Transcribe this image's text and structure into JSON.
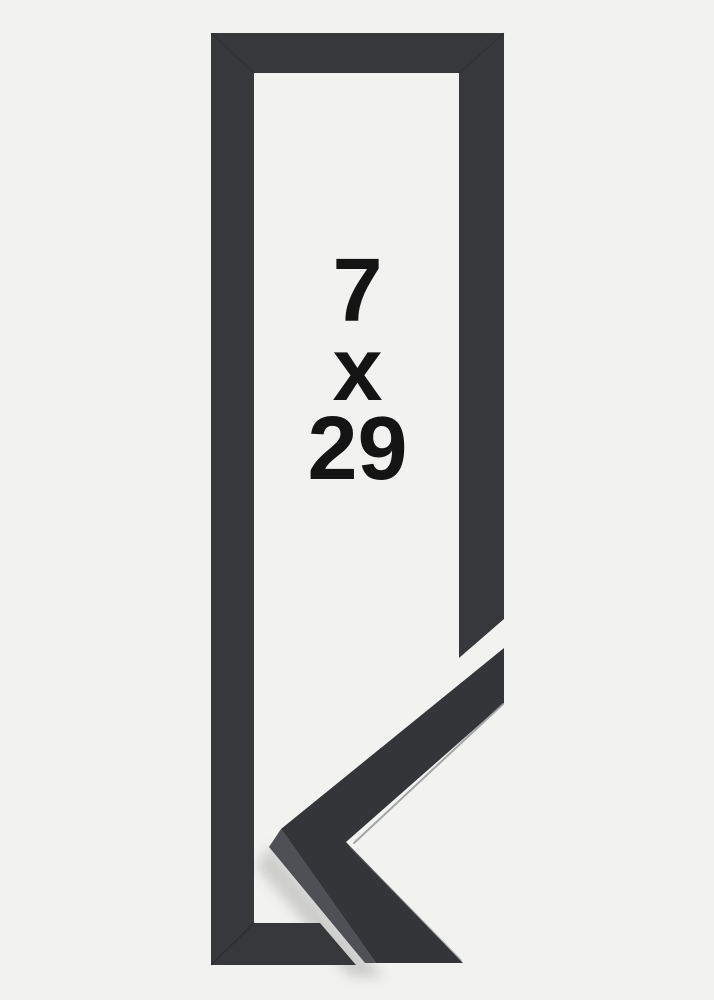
{
  "product": {
    "description": "black picture frame corner sample photo",
    "size_label": {
      "lines": [
        "7",
        "x",
        "29"
      ],
      "full": "7 x 29"
    }
  },
  "colors": {
    "background": "#f2f2f1",
    "opening": "#f2f2f1",
    "frame": "#37383b",
    "sample": "#343538",
    "sample_side": "#4e5055",
    "edge_highlight": "#8f9195",
    "seam": "#1f2023",
    "shadow": "#a8a8a6",
    "text": "#141414"
  }
}
